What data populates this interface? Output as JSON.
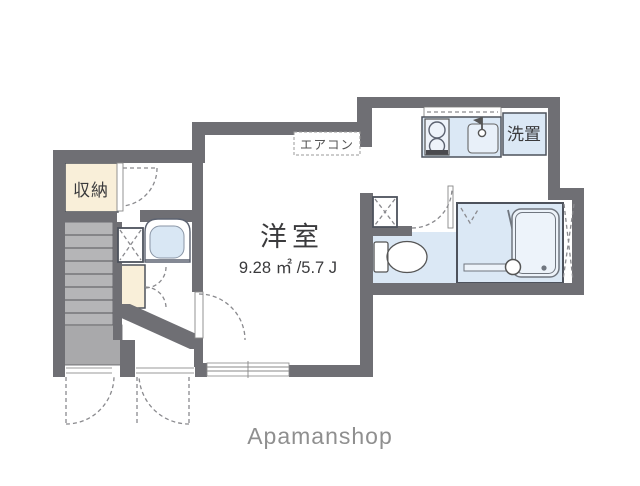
{
  "plan": {
    "labels": {
      "storage": "収納",
      "aircon": "エアコン",
      "washer": "洗置",
      "room": "洋室",
      "room_area": "9.28 ㎡ /5.7 J",
      "watermark": "Apamanshop"
    },
    "fixture_names": [
      "stairs",
      "washbasin",
      "shoe-cabinet",
      "pipe-space",
      "kitchen-stove",
      "kitchen-sink",
      "toilet",
      "bathtub",
      "entrance-doors"
    ],
    "colors": {
      "wall": "#6f6f74",
      "water_room_fill": "#dbe8f5",
      "closet_fill": "#f9efd9",
      "stairs_fill": "#b5b5b7",
      "landing_fill": "#a9a9ab",
      "background": "#ffffff",
      "text": "#3a3a3c",
      "watermark": "#8f8f8f"
    }
  }
}
